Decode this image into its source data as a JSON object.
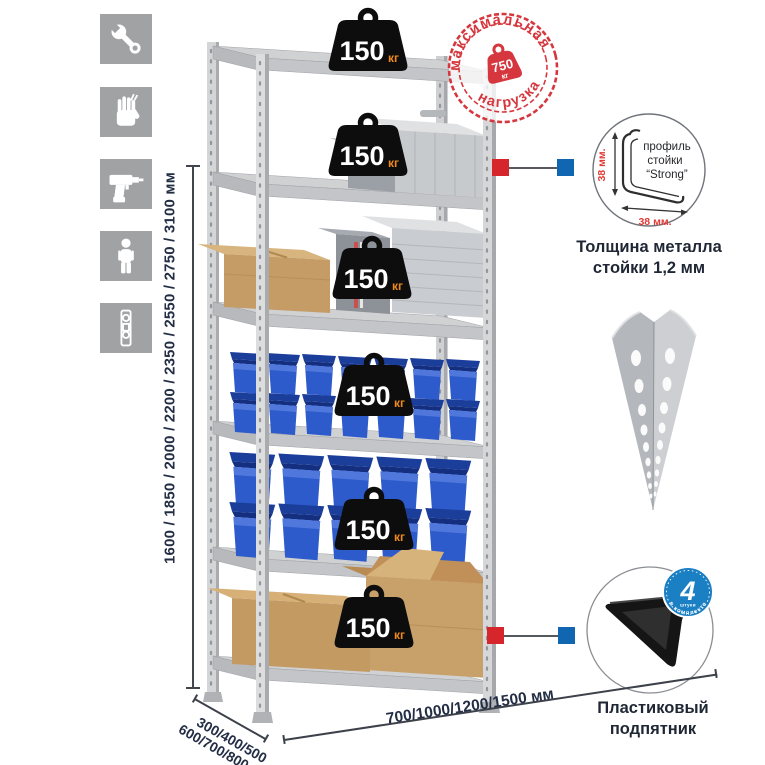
{
  "sidebar": {
    "icons": [
      "wrench",
      "gloves",
      "drill",
      "person",
      "level"
    ]
  },
  "dimensions": {
    "height": "1600 / 1850 / 2000 / 2200 / 2350 / 2550 / 2750 / 3100 мм",
    "depth_line1": "300/400/500",
    "depth_line2": "600/700/800 мм",
    "width": "700/1000/1200/1500 мм"
  },
  "load_badge": {
    "value": "150",
    "unit": "кг"
  },
  "max_load_stamp": {
    "top_text": "максимальная",
    "bottom_text": "нагрузка",
    "value": "750",
    "unit": "кг"
  },
  "profile_detail": {
    "line1": "профиль",
    "line2": "стойки",
    "line3": "“Strong”",
    "vertical_dim": "38 мм.",
    "horizontal_dim": "38 мм.",
    "caption1": "Толщина металла",
    "caption2": "стойки 1,2 мм"
  },
  "foot_detail": {
    "badge_value": "4",
    "badge_unit": "штуки",
    "badge_arc": "в комплекте",
    "caption1": "Пластиковый",
    "caption2": "подпятник"
  },
  "colors": {
    "stamp_red": "#d6373e",
    "marker_red": "#d6252b",
    "marker_blue": "#1166b2",
    "badge_orange": "#f0891d",
    "bin_blue": "#2d5bcb",
    "metal_gray": "#cfd0d2",
    "icon_gray": "#a1a2a4",
    "dim_text": "#232e45"
  }
}
